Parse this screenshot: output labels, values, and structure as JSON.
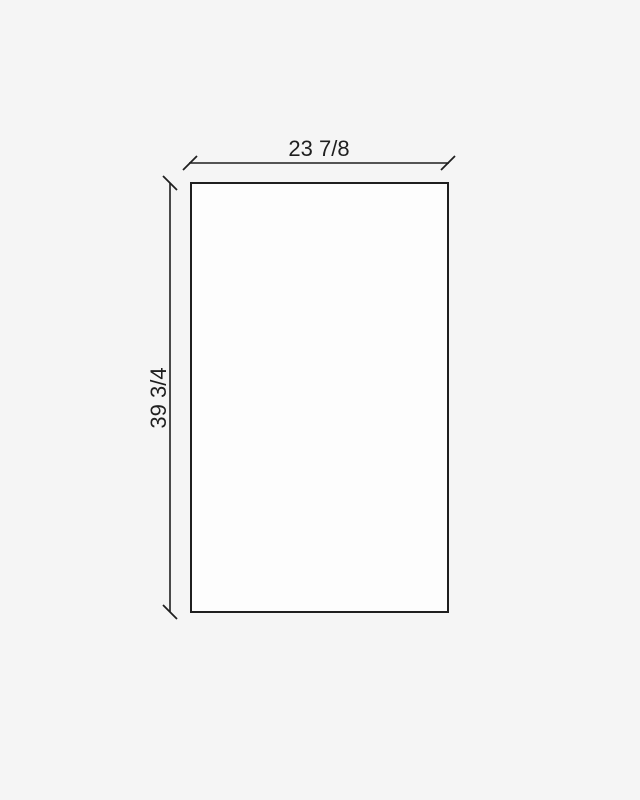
{
  "drawing": {
    "type": "panel-dimension-diagram",
    "width_label": "23 7/8",
    "height_label": "39 3/4",
    "width_value_inches": 23.875,
    "height_value_inches": 39.75
  },
  "colors": {
    "background": "#f5f5f5",
    "panel_fill": "#fdfdfd",
    "line": "#1f1f1f",
    "text": "#1f1f1f"
  }
}
